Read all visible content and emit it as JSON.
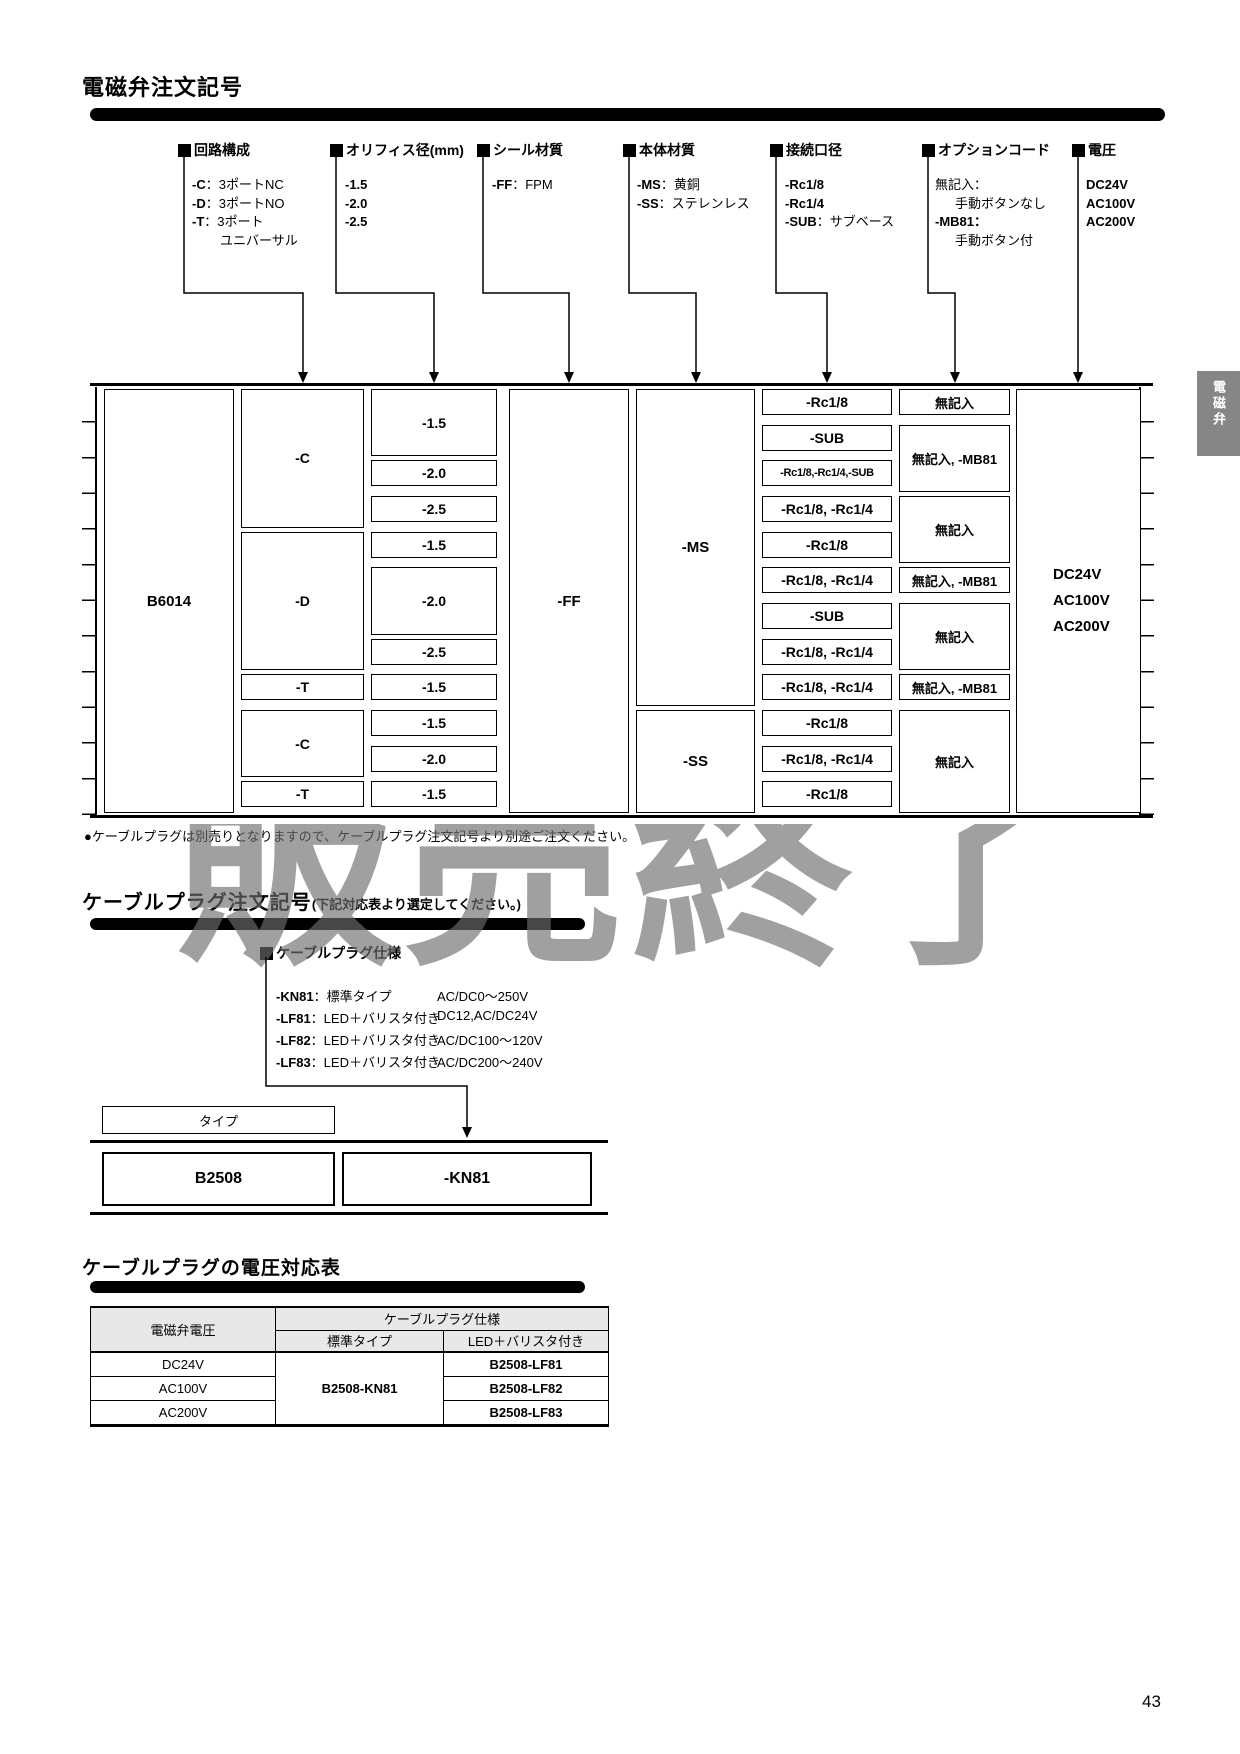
{
  "colors": {
    "ink": "#000000",
    "tab_bg": "#868686",
    "watermark_gray": "#6e6e6e",
    "table_header_bg": "#e8e8e8"
  },
  "page_number": "43",
  "side_tab": {
    "label": "電磁弁"
  },
  "watermark": {
    "text": "販売終了"
  },
  "s1": {
    "title": "電磁弁注文記号",
    "type_label": "タイプ",
    "headers": [
      "回路構成",
      "オリフィス径(mm)",
      "シール材質",
      "本体材質",
      "接続口径",
      "オプションコード",
      "電圧"
    ],
    "h1_opts": [
      {
        "code": "-C",
        "desc": "：3ポートNC"
      },
      {
        "code": "-D",
        "desc": "：3ポートNO"
      },
      {
        "code": "-T",
        "desc": "：3ポート"
      },
      {
        "cont": "ユニバーサル"
      }
    ],
    "h2_opts": [
      "-1.5",
      "-2.0",
      "-2.5"
    ],
    "h3_opts": [
      {
        "code": "-FF",
        "desc": "：FPM"
      }
    ],
    "h4_opts": [
      {
        "code": "-MS",
        "desc": "：黄銅"
      },
      {
        "code": "-SS",
        "desc": "：ステレンレス"
      }
    ],
    "h5_opts": [
      {
        "code": "-Rc1/8",
        "desc": ""
      },
      {
        "code": "-Rc1/4",
        "desc": ""
      },
      {
        "code": "-SUB",
        "desc": "：サブベース"
      }
    ],
    "h6_opts": [
      {
        "code": "無記入："
      },
      {
        "cont": "手動ボタンなし"
      },
      {
        "code": "-MB81："
      },
      {
        "cont": "手動ボタン付"
      }
    ],
    "h7_opts": [
      "DC24V",
      "AC100V",
      "AC200V"
    ],
    "table": {
      "type_code": "B6014",
      "circuit": [
        "-C",
        "-D",
        "-T",
        "-C",
        "-T"
      ],
      "orifice": [
        "-1.5",
        "-2.0",
        "-2.5",
        "-1.5",
        "-2.0",
        "-2.5",
        "-1.5",
        "-1.5",
        "-2.0",
        "-1.5"
      ],
      "seal": "-FF",
      "body": [
        "-MS",
        "-SS"
      ],
      "conn": [
        "-Rc1/8",
        "-SUB",
        "-Rc1/8,-Rc1/4,-SUB",
        "-Rc1/8, -Rc1/4",
        "-Rc1/8",
        "-Rc1/8, -Rc1/4",
        "-SUB",
        "-Rc1/8, -Rc1/4",
        "-Rc1/8, -Rc1/4",
        "-Rc1/8",
        "-Rc1/8, -Rc1/4",
        "-Rc1/8"
      ],
      "opt": [
        "無記入",
        "無記入, -MB81",
        "無記入",
        "無記入, -MB81",
        "無記入",
        "無記入, -MB81",
        "無記入"
      ],
      "voltage": [
        "DC24V",
        "AC100V",
        "AC200V"
      ]
    },
    "note": "●ケーブルプラグは別売りとなりますので、ケーブルプラグ注文記号より別途ご注文ください。"
  },
  "s2": {
    "title_main": "ケーブルプラグ注文記号",
    "title_sub": "(下記対応表より選定してください。)",
    "spec_header": "ケーブルプラグ仕様",
    "specs": [
      {
        "code": "-KN81",
        "desc": "：標準タイプ",
        "volt": "AC/DC0～250V"
      },
      {
        "code": "-LF81",
        "desc": "：LED＋バリスタ付き",
        "volt": "DC12,AC/DC24V"
      },
      {
        "code": "-LF82",
        "desc": "：LED＋バリスタ付き",
        "volt": "AC/DC100～120V"
      },
      {
        "code": "-LF83",
        "desc": "：LED＋バリスタ付き",
        "volt": "AC/DC200～240V"
      }
    ],
    "type_label": "タイプ",
    "type_code": "B2508",
    "plug_code": "-KN81"
  },
  "s3": {
    "title": "ケーブルプラグの電圧対応表",
    "col_valve_voltage": "電磁弁電圧",
    "col_plug_spec": "ケーブルプラグ仕様",
    "col_standard": "標準タイプ",
    "col_led": "LED＋バリスタ付き",
    "rows": [
      {
        "voltage": "DC24V",
        "led": "B2508-LF81"
      },
      {
        "voltage": "AC100V",
        "led": "B2508-LF82"
      },
      {
        "voltage": "AC200V",
        "led": "B2508-LF83"
      }
    ],
    "standard_value": "B2508-KN81"
  }
}
